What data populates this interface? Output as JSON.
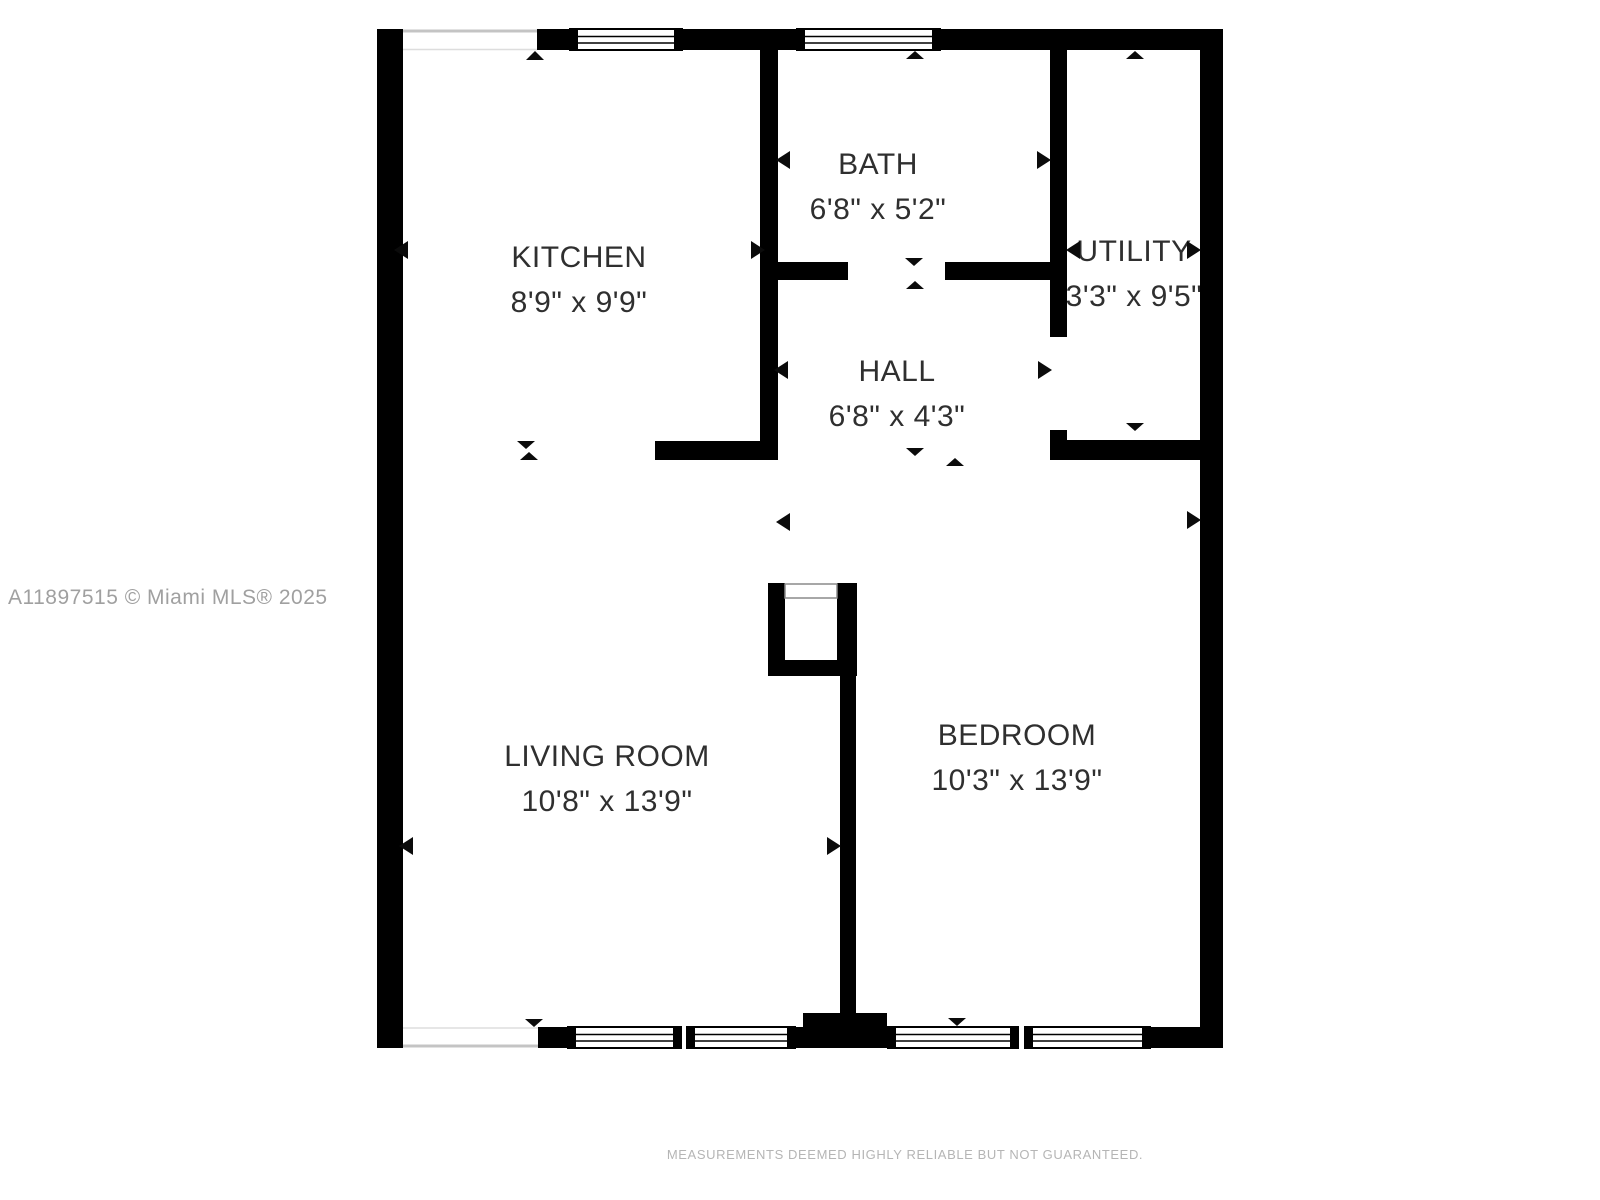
{
  "floorplan": {
    "rooms": {
      "kitchen": {
        "name": "KITCHEN",
        "dimensions": "8'9\" x 9'9\""
      },
      "bath": {
        "name": "BATH",
        "dimensions": "6'8\" x 5'2\""
      },
      "utility": {
        "name": "UTILITY",
        "dimensions": "3'3\" x 9'5\""
      },
      "hall": {
        "name": "HALL",
        "dimensions": "6'8\" x 4'3\""
      },
      "living_room": {
        "name": "LIVING ROOM",
        "dimensions": "10'8\" x 13'9\""
      },
      "bedroom": {
        "name": "BEDROOM",
        "dimensions": "10'3\" x 13'9\""
      }
    },
    "watermark": "A11897515 © Miami MLS® 2025",
    "disclaimer": "MEASUREMENTS DEEMED HIGHLY RELIABLE BUT NOT GUARANTEED.",
    "colors": {
      "wall": "#000000",
      "room_text": "#2f2f2f",
      "watermark_text": "#a0a0a0",
      "disclaimer_text": "#b5b5b5"
    }
  }
}
